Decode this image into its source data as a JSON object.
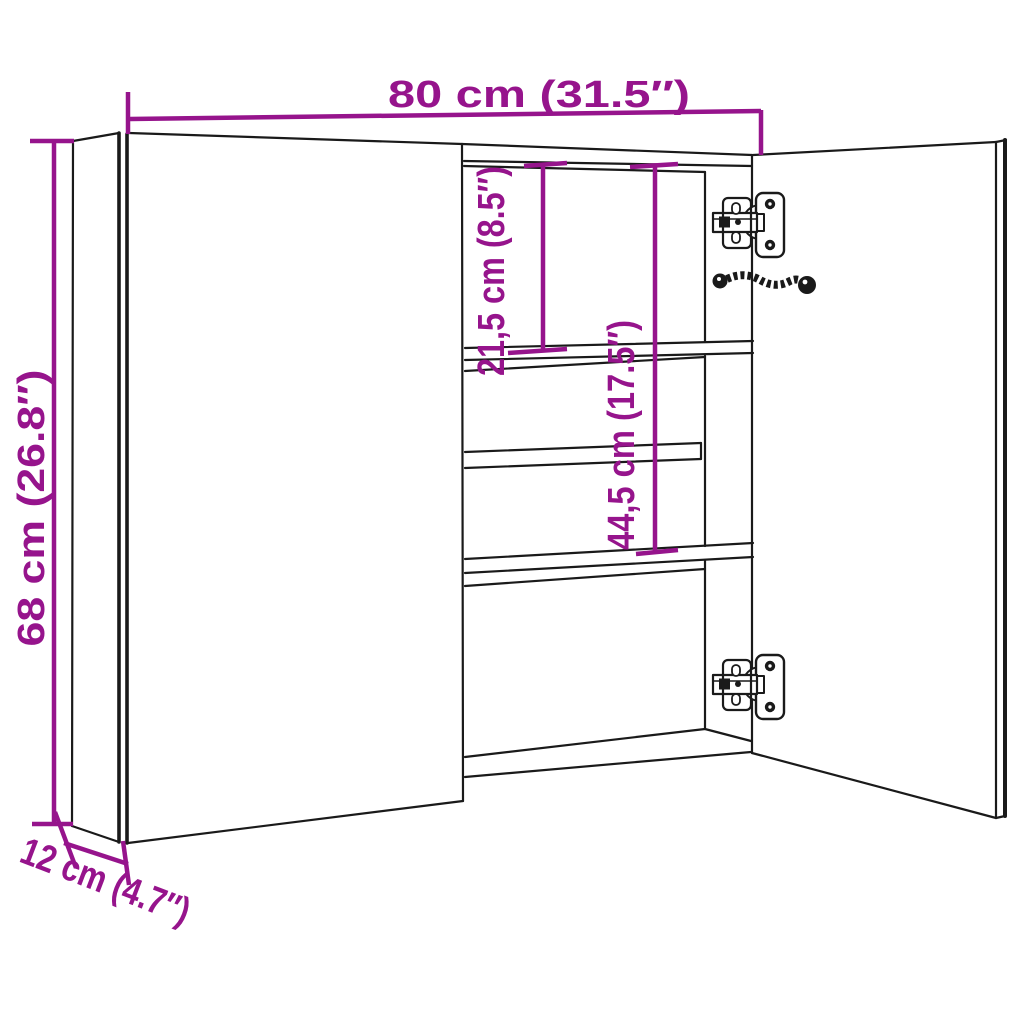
{
  "diagram": {
    "title": "bathroom-mirror-cabinet-dimension-diagram",
    "product": "Two-door mirror cabinet with interior shelves, shown with right door open",
    "dimensions": {
      "width_label": "80 cm (31.5″)",
      "height_label": "68 cm (26.8″)",
      "depth_label": "12 cm (4.7″)",
      "top_shelf_spacing_label": "21,5 cm (8.5″)",
      "middle_shelf_spacing_label": "44,5 cm (17.5″)"
    },
    "parts": {
      "left_door": "closed mirror door",
      "right_door": "open mirror door",
      "hinges": "2 concealed cup hinges",
      "cable": "LED power cable",
      "shelves": "2 fixed shelves + 1 glass shelf"
    }
  },
  "colors": {
    "dimension_annotation": "#96148C",
    "line_art": "#1A1A1A",
    "background": "#FFFFFF"
  }
}
